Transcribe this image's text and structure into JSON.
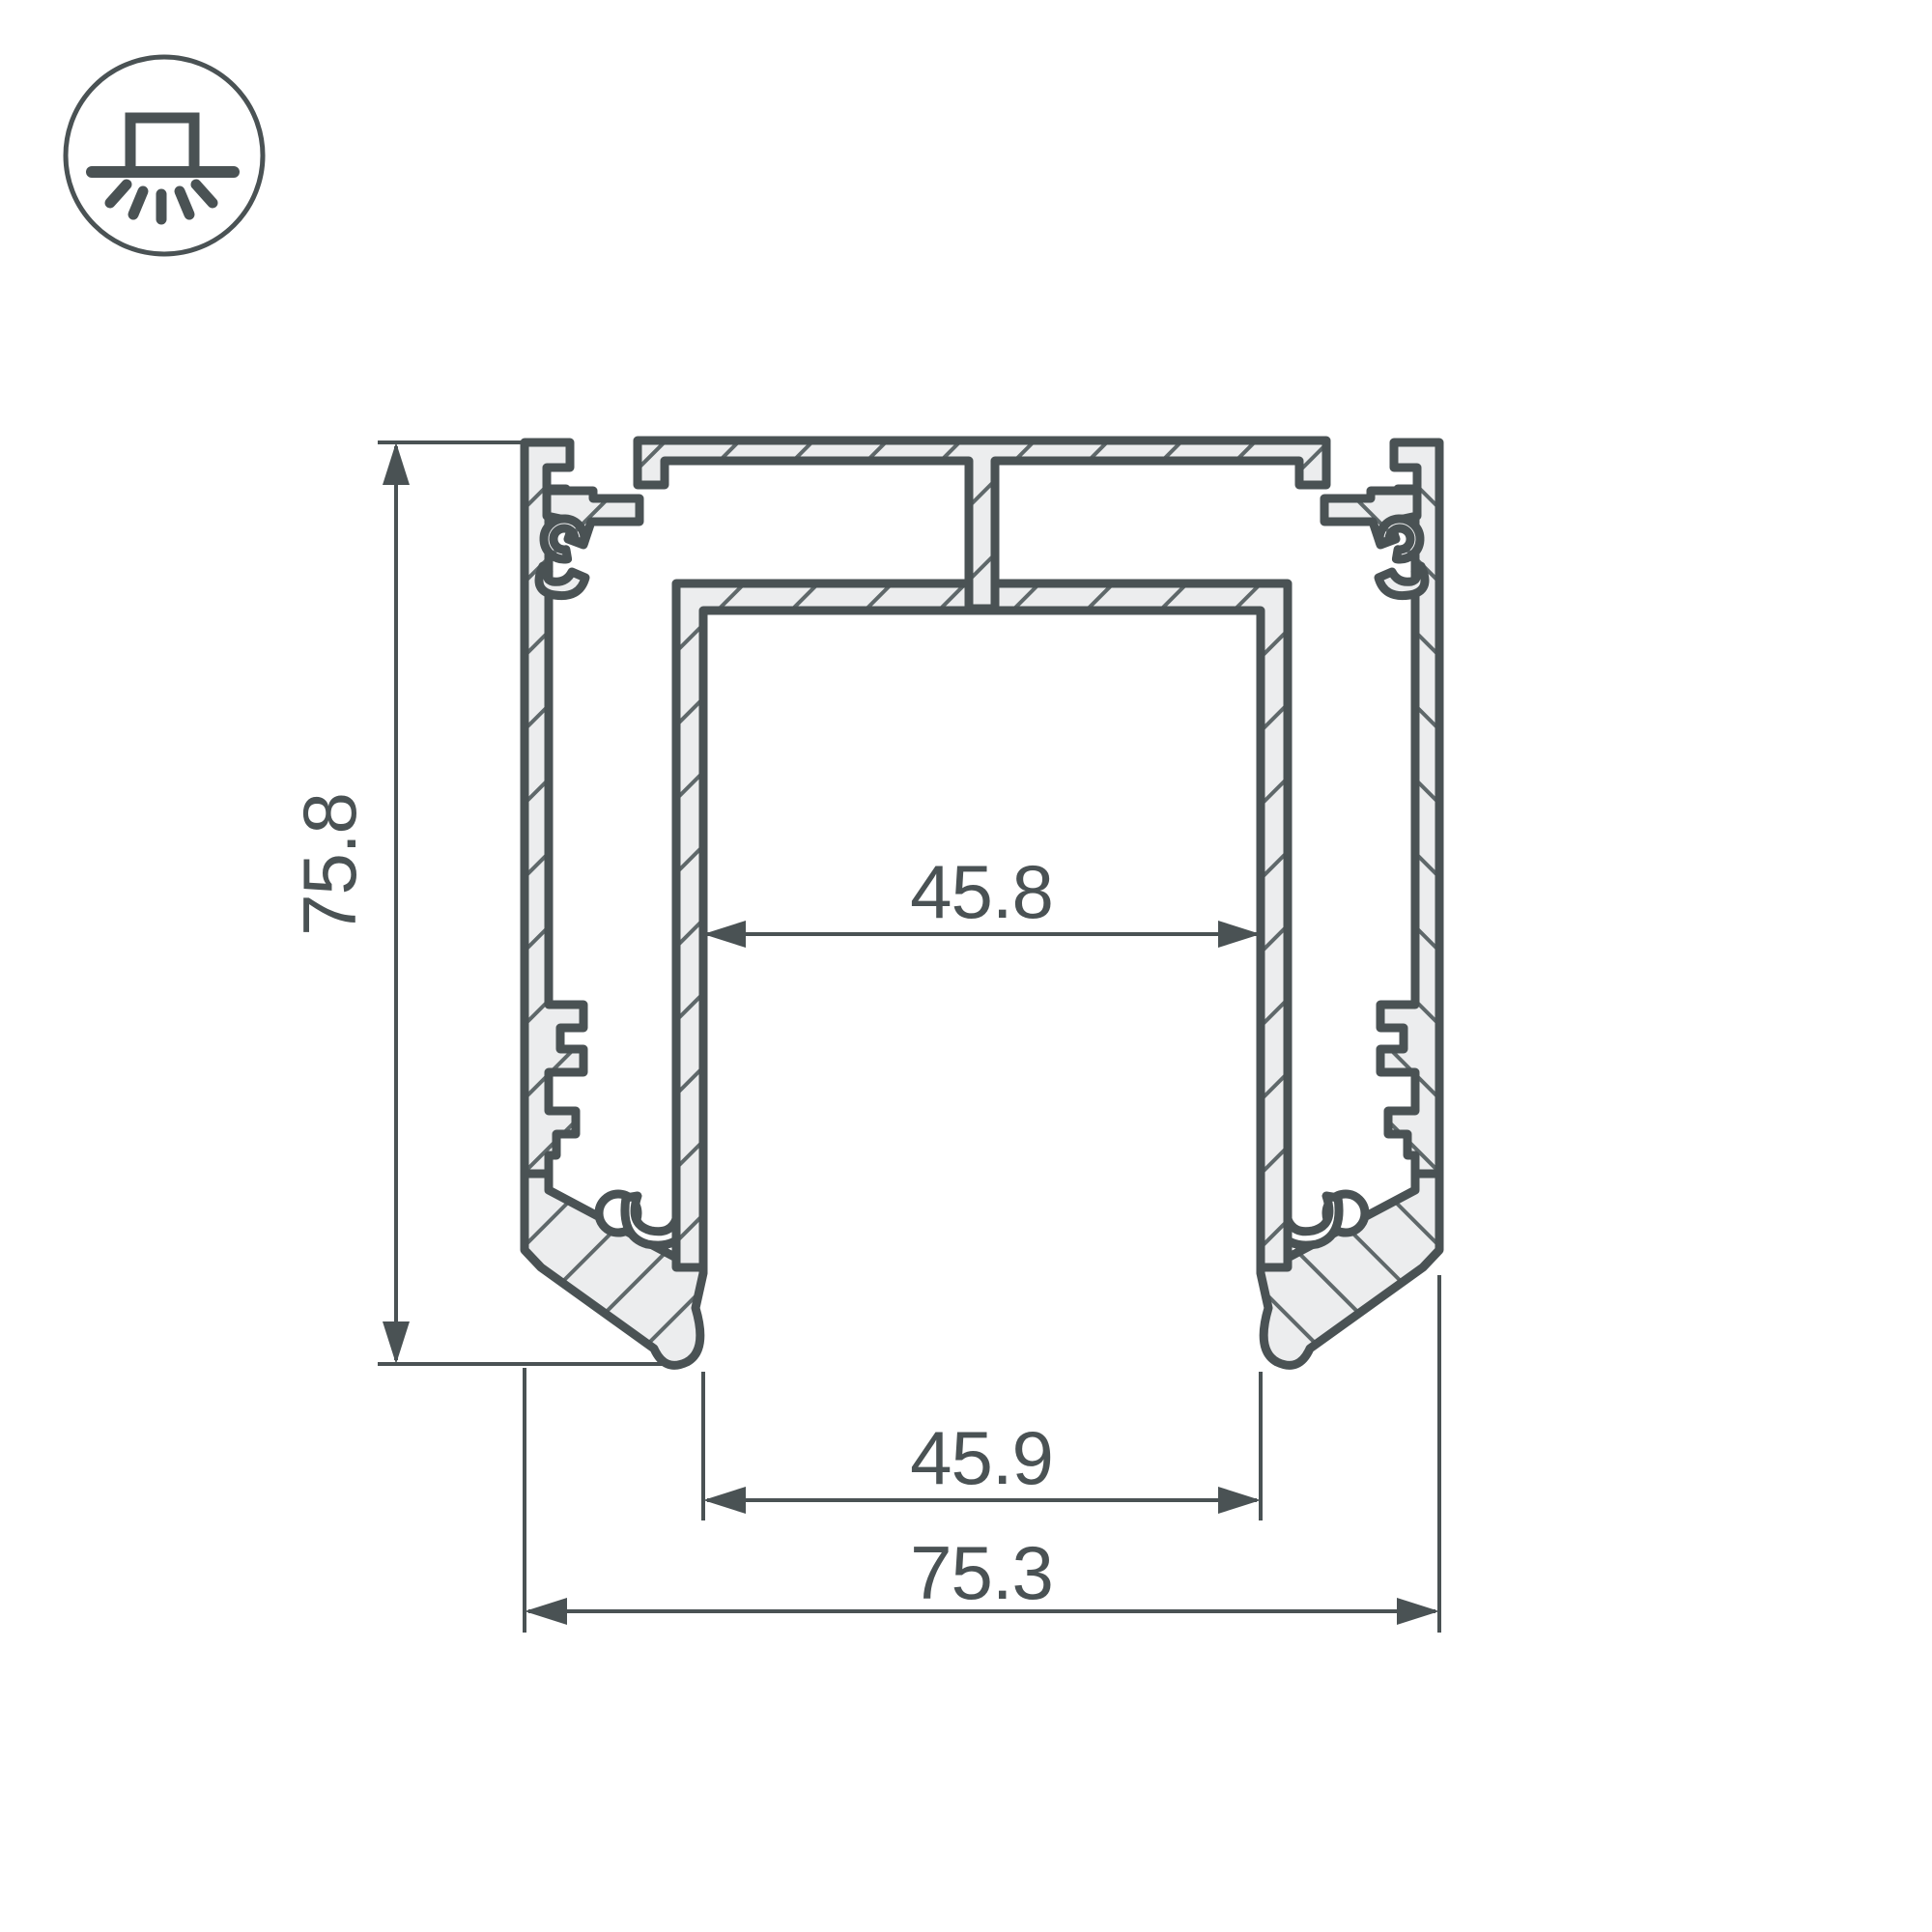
{
  "drawing": {
    "title": "aluminum-led-profile-cross-section",
    "view": "section",
    "icon": {
      "name": "surface-mounted-light-icon",
      "meaning": "surface / накладной mounting type"
    },
    "dimensions": {
      "height": "75.8",
      "inner_width_top": "45.8",
      "inner_width_bottom": "45.9",
      "overall_width": "75.3"
    },
    "colors": {
      "line": "#4a5254",
      "material_fill": "#ecedee",
      "hatch": "#5f686a",
      "background": "#ffffff"
    }
  }
}
